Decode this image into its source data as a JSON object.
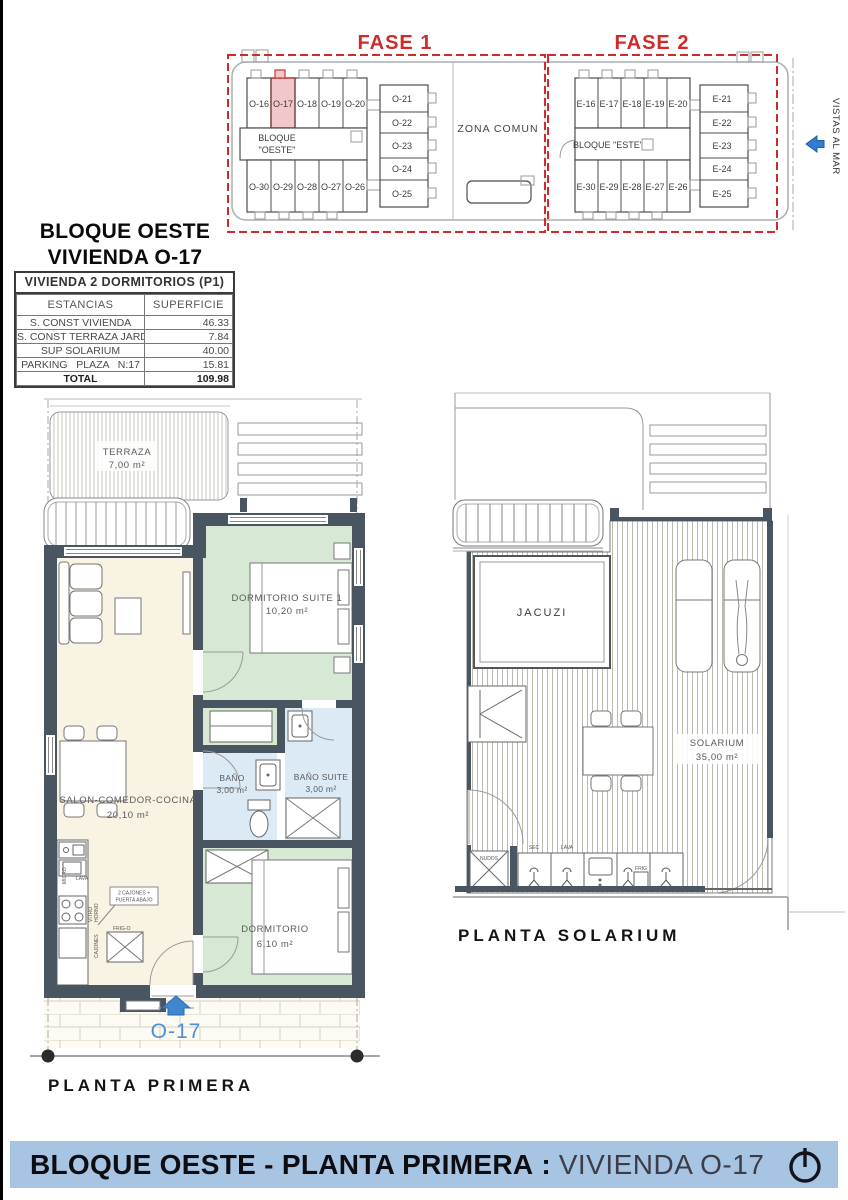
{
  "site_plan": {
    "fase1": "FASE 1",
    "fase2": "FASE 2",
    "zona_comun": "ZONA COMUN",
    "bloque_oeste_line1": "BLOQUE",
    "bloque_oeste_line2": "\"OESTE\"",
    "bloque_este": "BLOQUE \"ESTE\"",
    "vistas_al_mar": "VISTAS AL MAR",
    "oeste_top": [
      "O-16",
      "O-17",
      "O-18",
      "O-19",
      "O-20"
    ],
    "oeste_col": [
      "O-21",
      "O-22",
      "O-23",
      "O-24",
      "O-25"
    ],
    "oeste_bottom": [
      "O-30",
      "O-29",
      "O-28",
      "O-27",
      "O-26"
    ],
    "este_top": [
      "E-16",
      "E-17",
      "E-18",
      "E-19",
      "E-20"
    ],
    "este_col": [
      "E-21",
      "E-22",
      "E-23",
      "E-24",
      "E-25"
    ],
    "este_bottom": [
      "E-30",
      "E-29",
      "E-28",
      "E-27",
      "E-26"
    ],
    "highlighted_unit": "O-17"
  },
  "unit_info": {
    "title1": "BLOQUE OESTE",
    "title2": "VIVIENDA O-17",
    "table_title": "VIVIENDA 2 DORMITORIOS (P1)",
    "col_estancias": "ESTANCIAS",
    "col_superficie": "SUPERFICIE",
    "rows": [
      {
        "label": "S. CONST VIVIENDA",
        "value": "46.33"
      },
      {
        "label": "S. CONST TERRAZA JARDÍN",
        "value": "7.84"
      },
      {
        "label": "SUP SOLARIUM",
        "value": "40.00"
      },
      {
        "label": "PARKING   PLAZA   N:17",
        "value": "15.81"
      },
      {
        "label": "TOTAL",
        "value": "109.98"
      }
    ]
  },
  "planta_primera": {
    "label": "PLANTA PRIMERA",
    "entrance_unit": "O-17",
    "terraza_name": "TERRAZA",
    "terraza_area": "7,00 m²",
    "suite_name": "DORMITORIO SUITE 1",
    "suite_area": "10,20 m²",
    "salon_name": "SALON-COMEDOR-COCINA",
    "salon_area": "20,10 m²",
    "bano_name": "BAÑO",
    "bano_area": "3,00 m²",
    "bano_suite_name": "BAÑO SUITE",
    "bano_suite_area": "3,00 m²",
    "dorm_name": "DORMITORIO",
    "dorm_area": "6,10 m²",
    "kitchen": {
      "micro": "MICRO",
      "lava": "LAVA",
      "vitro": "VITRO",
      "horno": "HORNO",
      "cajones": "CAJONES",
      "frigo": "FRIG-O",
      "note1": "2 CAJONES +",
      "note2": "PUERTA ABAJO"
    }
  },
  "planta_solarium": {
    "label": "PLANTA SOLARIUM",
    "jacuzi": "JACUZI",
    "solarium_name": "SOLARIUM",
    "solarium_area": "35,00 m²",
    "nudos": "NUDOS",
    "sec": "SEC",
    "lava": "LAVA",
    "frig": "FRIG"
  },
  "footer": {
    "bold": "BLOQUE OESTE - PLANTA PRIMERA",
    "sep": ":",
    "light": "VIVIENDA O-17"
  },
  "colors": {
    "accent_red": "#cf2b2b",
    "accent_blue": "#4a8ed6",
    "banner": "#a7c4e3",
    "wall": "#4a5562",
    "bedroom_green": "#d7e8d5",
    "bath_blue": "#dceaf6",
    "living_cream": "#f8f3e3",
    "highlight_pink": "#f2c7ca"
  }
}
